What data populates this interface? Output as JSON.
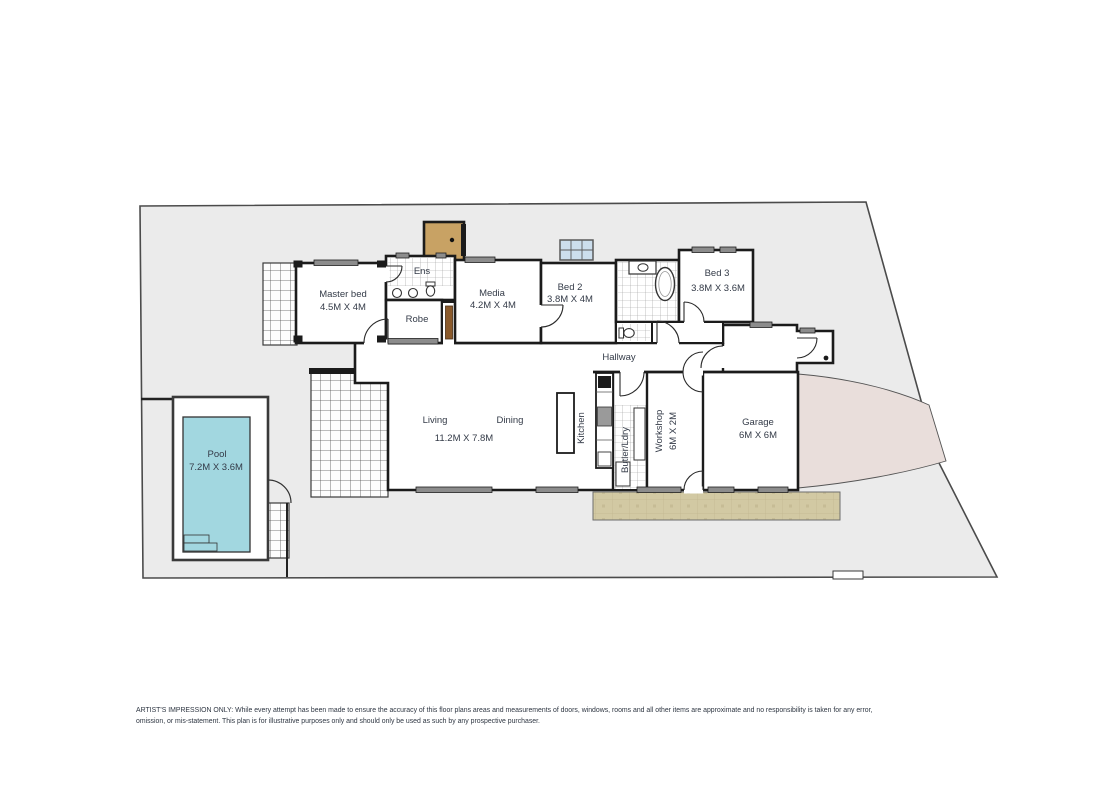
{
  "plan": {
    "rooms": {
      "master_bed": {
        "name": "Master bed",
        "dims": "4.5M X 4M"
      },
      "ens": {
        "name": "Ens"
      },
      "robe": {
        "name": "Robe"
      },
      "media": {
        "name": "Media",
        "dims": "4.2M X 4M"
      },
      "bed2": {
        "name": "Bed 2",
        "dims": "3.8M X 4M"
      },
      "bed3": {
        "name": "Bed 3",
        "dims": "3.8M X 3.6M"
      },
      "hallway": {
        "name": "Hallway"
      },
      "living": {
        "name": "Living"
      },
      "dining": {
        "name": "Dining"
      },
      "living_dining": {
        "dims": "11.2M X 7.8M"
      },
      "kitchen": {
        "name": "Kitchen"
      },
      "butler_laundry": {
        "name": "Butler/Ldry"
      },
      "workshop": {
        "name": "Workshop",
        "dims": "6M X 2M"
      },
      "garage": {
        "name": "Garage",
        "dims": "6M X 6M"
      },
      "pool": {
        "name": "Pool",
        "dims": "7.2M X 3.6M"
      }
    },
    "disclaimer": {
      "line1": "ARTIST'S IMPRESSION ONLY: While every attempt has been made to ensure the accuracy of this floor plans areas and measurements of doors, windows, rooms and all other items are approximate and no responsibility is taken for any error,",
      "line2": "omission, or mis-statement. This plan is for illustrative purposes only and should only be used as such by any prospective purchaser."
    },
    "colors": {
      "land": "#ebebeb",
      "walls": "#1b1b1b",
      "pool_water": "#a2d7e0",
      "driveway": "#e9dedb",
      "paving": "#d2c9a3",
      "timber": "#c8a264",
      "window_bar": "#8c8c8c"
    }
  }
}
